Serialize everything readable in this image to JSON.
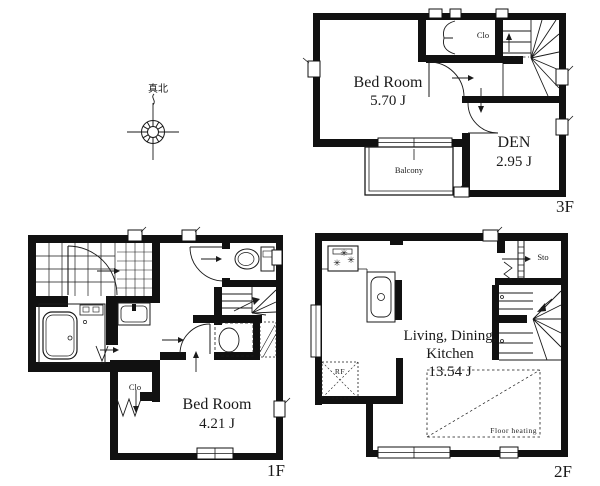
{
  "compass": {
    "north_label": "真北"
  },
  "floors": {
    "f3": {
      "label": "3F",
      "bedroom_name": "Bed Room",
      "bedroom_area": "5.70 J",
      "den_name": "DEN",
      "den_area": "2.95 J",
      "closet_label": "Clo",
      "balcony_label": "Balcony"
    },
    "f2": {
      "label": "2F",
      "ldk_line1": "Living, Dining,",
      "ldk_line2": "Kitchen",
      "ldk_area": "13.54 J",
      "storage_label": "Sto",
      "refrigerator_label": "RF",
      "floor_heating_label": "Floor heating",
      "burner_icon": "✳"
    },
    "f1": {
      "label": "1F",
      "bedroom_name": "Bed Room",
      "bedroom_area": "4.21 J",
      "closet_label": "Clo"
    }
  },
  "colors": {
    "wall": "#111111",
    "background": "#ffffff"
  }
}
